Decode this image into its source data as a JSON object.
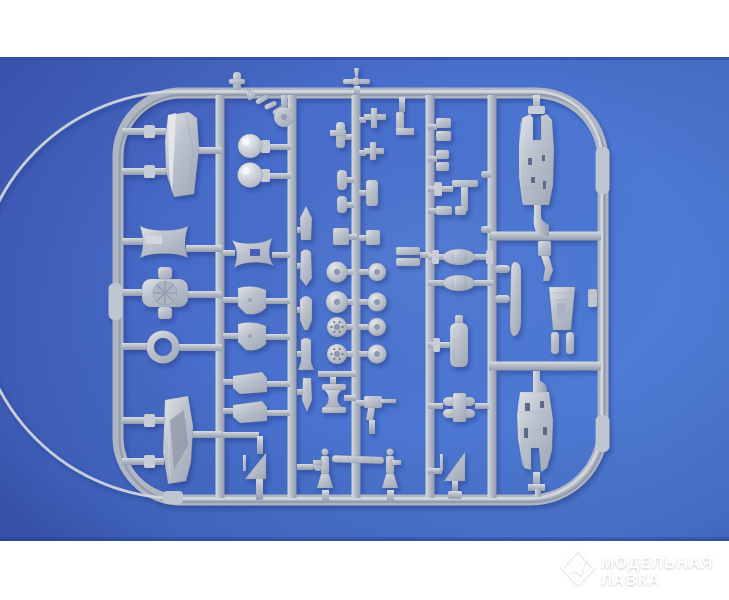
{
  "scene": {
    "subject": "Grey injection-moulded plastic model kit sprue photographed on a blue backdrop",
    "colors": {
      "border_band": "#ffffff",
      "backdrop_blue": "#4668c8",
      "backdrop_blue_light": "#4f7cd6",
      "backdrop_blue_dark": "#35489f",
      "plastic_base": "#b7bdc8",
      "plastic_highlight": "#dde1e6",
      "plastic_shadow": "#8d97a9"
    },
    "sprue": {
      "material": "grey styrene plastic",
      "frame_shape": "rounded-rectangle runner frame with five internal vertical runners and two horizontal runners on the right side",
      "parts": [
        "engine cowling half (upper left)",
        "ball turret domes (2)",
        "pulley disc with linkage chain",
        "fairing mirror plates (2)",
        "radial engine insert",
        "cooling ring",
        "lower cowling half (lower left)",
        "wing-root fairings (4)",
        "tail fins (2)",
        "bombs and drop ordnance (5)",
        "main wheels (8)",
        "two-blade propeller",
        "small airframe brackets and tees",
        "tailplane halves (2)",
        "fuel tank",
        "exhaust stacks",
        "tail-wheel struts (2)",
        "segmented push rod",
        "cable spool",
        "machine gun",
        "fuselage gun-bay half (upper right)",
        "propeller blade",
        "cockpit tub with linkage arm",
        "fuselage gun-bay half (lower right)"
      ]
    }
  },
  "watermark": {
    "logo_icon": "paper-plane-diamond-icon",
    "line1": "МОДЕЛЬНАЯ",
    "line2": "ЛАВКА",
    "text_color": "#ffffff"
  }
}
